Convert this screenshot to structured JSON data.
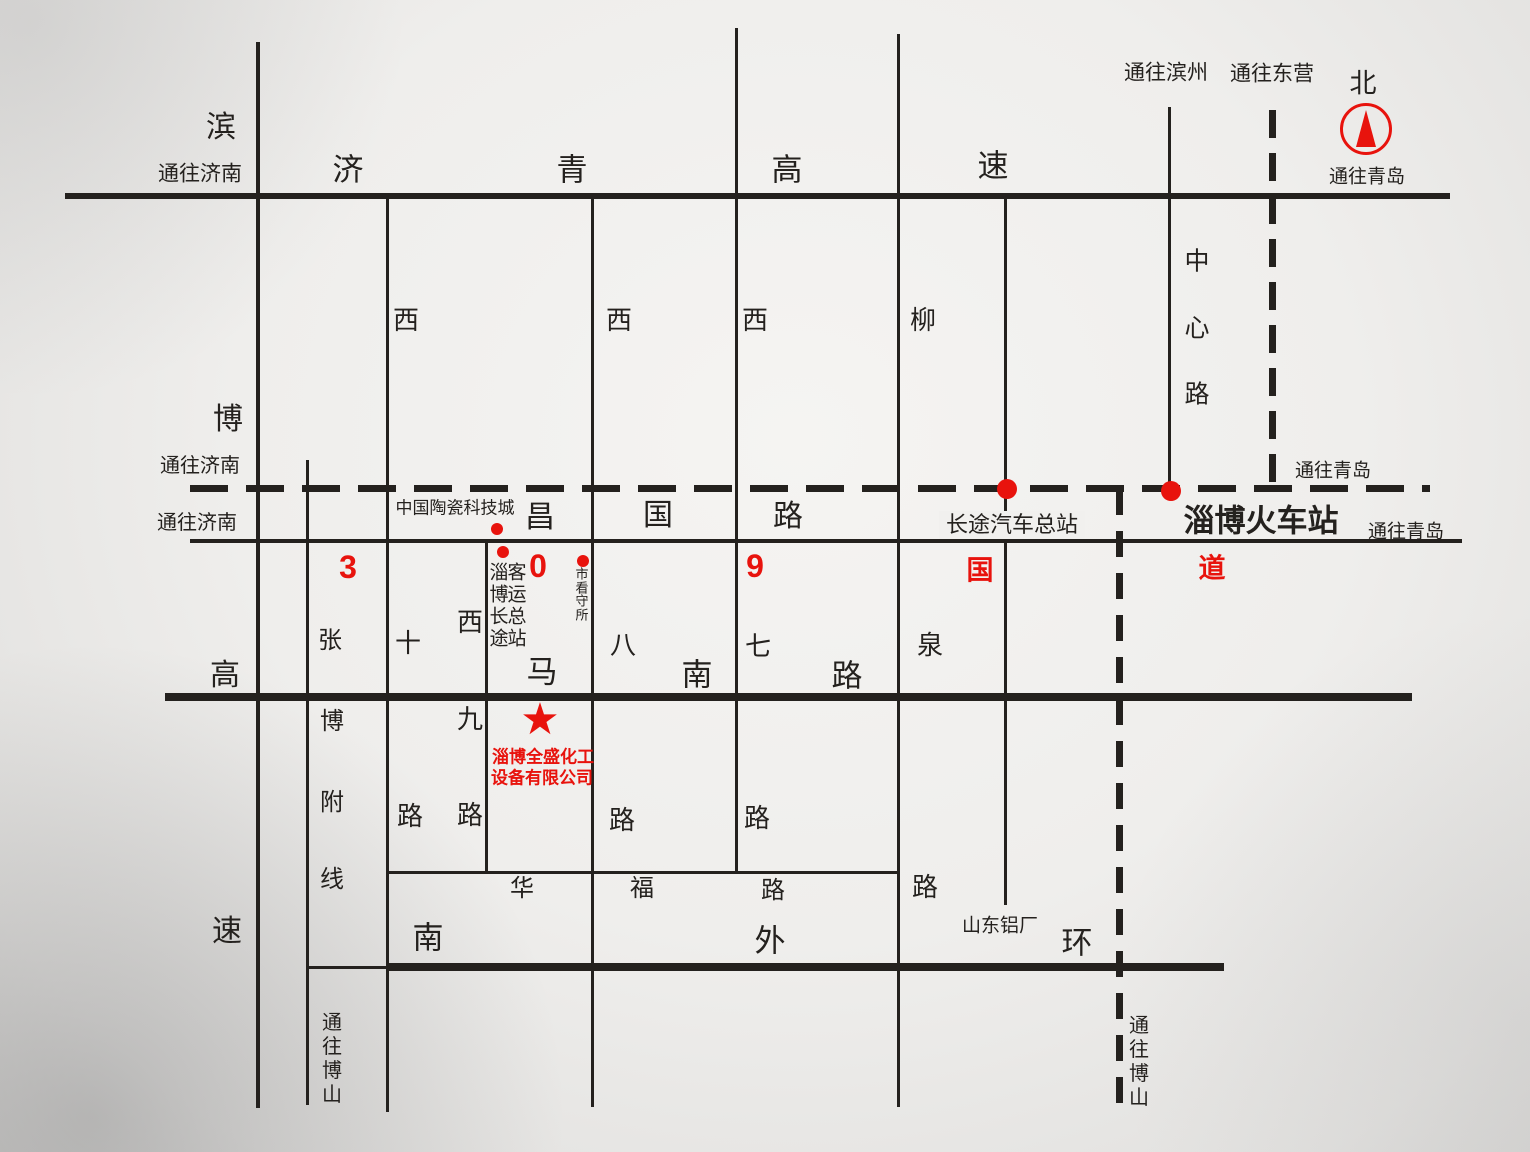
{
  "colors": {
    "ink": "#24211e",
    "red": "#e8130d",
    "paper": "#f1f0ee"
  },
  "company": {
    "name_line1": "淄博全盛化工",
    "name_line2": "设备有限公司"
  },
  "compass": {
    "north_label": "北"
  },
  "roads": [
    {
      "name": "jiqing-expressway",
      "cn": "济青高速",
      "o": "h",
      "x": 65,
      "y": 193,
      "len": 1385,
      "t": 6
    },
    {
      "name": "g309-national-road",
      "cn": "309国道",
      "o": "h",
      "x": 190,
      "y": 485,
      "len": 1240,
      "t": 7,
      "dash": [
        38,
        18
      ]
    },
    {
      "name": "changguo-road",
      "cn": "昌国路",
      "o": "h",
      "x": 190,
      "y": 539,
      "len": 1272,
      "t": 4
    },
    {
      "name": "manan-road",
      "cn": "马南路",
      "o": "h",
      "x": 165,
      "y": 693,
      "len": 1247,
      "t": 8
    },
    {
      "name": "huafu-road",
      "cn": "华福路",
      "o": "h",
      "x": 386,
      "y": 871,
      "len": 513,
      "t": 3
    },
    {
      "name": "nanwaihuan-west-segment",
      "cn": "南外环",
      "o": "h",
      "x": 308,
      "y": 966,
      "len": 80,
      "t": 3
    },
    {
      "name": "nanwaihuan-road",
      "cn": "南外环",
      "o": "h",
      "x": 386,
      "y": 963,
      "len": 838,
      "t": 8
    },
    {
      "name": "binbo-expressway",
      "cn": "滨博高速",
      "o": "v",
      "x": 256,
      "y": 42,
      "len": 1066,
      "t": 4
    },
    {
      "name": "zhangbo-branch-line",
      "cn": "张博附线",
      "o": "v",
      "x": 306,
      "y": 460,
      "len": 645,
      "t": 3
    },
    {
      "name": "xishi-road",
      "cn": "西十路",
      "o": "v",
      "x": 386,
      "y": 196,
      "len": 916,
      "t": 3
    },
    {
      "name": "xijiu-road",
      "cn": "西九路",
      "o": "v",
      "x": 485,
      "y": 539,
      "len": 334,
      "t": 3
    },
    {
      "name": "xiba-road",
      "cn": "西八路",
      "o": "v",
      "x": 591,
      "y": 196,
      "len": 911,
      "t": 3
    },
    {
      "name": "xiqi-road",
      "cn": "西七路",
      "o": "v",
      "x": 735,
      "y": 28,
      "len": 845,
      "t": 3
    },
    {
      "name": "liuquan-road",
      "cn": "柳泉路",
      "o": "v",
      "x": 897,
      "y": 34,
      "len": 1073,
      "t": 3
    },
    {
      "name": "bus-terminal-road",
      "o": "v",
      "x": 1004,
      "y": 196,
      "len": 709,
      "t": 3
    },
    {
      "name": "huanshan-dashed-road",
      "o": "v",
      "x": 1116,
      "y": 489,
      "len": 621,
      "t": 7,
      "dash": [
        26,
        16
      ]
    },
    {
      "name": "zhongxin-road",
      "cn": "中心路",
      "o": "v",
      "x": 1168,
      "y": 107,
      "len": 384,
      "t": 3
    },
    {
      "name": "dongying-dashed-road",
      "o": "v",
      "x": 1269,
      "y": 110,
      "len": 382,
      "t": 7,
      "dash": [
        28,
        15
      ]
    }
  ],
  "labels": [
    {
      "name": "jiqing-char-1",
      "text": "济",
      "x": 348,
      "y": 170,
      "fs": 31
    },
    {
      "name": "jiqing-char-2",
      "text": "青",
      "x": 572,
      "y": 170,
      "fs": 31
    },
    {
      "name": "jiqing-char-3",
      "text": "高",
      "x": 787,
      "y": 170,
      "fs": 31
    },
    {
      "name": "jiqing-char-4",
      "text": "速",
      "x": 993,
      "y": 166,
      "fs": 31
    },
    {
      "name": "binbo-char-1",
      "text": "滨",
      "x": 221,
      "y": 128,
      "fs": 30
    },
    {
      "name": "binbo-char-2",
      "text": "博",
      "x": 228,
      "y": 420,
      "fs": 30
    },
    {
      "name": "binbo-char-3",
      "text": "高",
      "x": 225,
      "y": 676,
      "fs": 30
    },
    {
      "name": "binbo-char-4",
      "text": "速",
      "x": 227,
      "y": 932,
      "fs": 30
    },
    {
      "name": "changguo-char-1",
      "text": "昌",
      "x": 540,
      "y": 518,
      "fs": 30
    },
    {
      "name": "changguo-char-2",
      "text": "国",
      "x": 658,
      "y": 516,
      "fs": 30
    },
    {
      "name": "changguo-char-3",
      "text": "路",
      "x": 788,
      "y": 517,
      "fs": 30
    },
    {
      "name": "manan-char-1",
      "text": "马",
      "x": 542,
      "y": 672,
      "fs": 31
    },
    {
      "name": "manan-char-2",
      "text": "南",
      "x": 697,
      "y": 675,
      "fs": 31
    },
    {
      "name": "manan-char-3",
      "text": "路",
      "x": 847,
      "y": 676,
      "fs": 31
    },
    {
      "name": "nanwaihuan-char-1",
      "text": "南",
      "x": 428,
      "y": 938,
      "fs": 31
    },
    {
      "name": "nanwaihuan-char-2",
      "text": "外",
      "x": 770,
      "y": 941,
      "fs": 31
    },
    {
      "name": "nanwaihuan-char-3",
      "text": "环",
      "x": 1077,
      "y": 943,
      "fs": 31
    },
    {
      "name": "huafu-char-1",
      "text": "华",
      "x": 522,
      "y": 889,
      "fs": 24
    },
    {
      "name": "huafu-char-2",
      "text": "福",
      "x": 642,
      "y": 889,
      "fs": 24
    },
    {
      "name": "huafu-char-3",
      "text": "路",
      "x": 773,
      "y": 891,
      "fs": 24
    },
    {
      "name": "zhangbo-char-1",
      "text": "张",
      "x": 330,
      "y": 641,
      "fs": 24
    },
    {
      "name": "zhangbo-char-2",
      "text": "博",
      "x": 332,
      "y": 722,
      "fs": 24
    },
    {
      "name": "zhangbo-char-3",
      "text": "附",
      "x": 332,
      "y": 803,
      "fs": 24
    },
    {
      "name": "zhangbo-char-4",
      "text": "线",
      "x": 332,
      "y": 880,
      "fs": 24
    },
    {
      "name": "xishi-char-1",
      "text": "西",
      "x": 406,
      "y": 320,
      "fs": 26
    },
    {
      "name": "xishi-char-2",
      "text": "十",
      "x": 408,
      "y": 643,
      "fs": 26
    },
    {
      "name": "xishi-char-3",
      "text": "路",
      "x": 410,
      "y": 816,
      "fs": 26
    },
    {
      "name": "xijiu-char-1",
      "text": "西",
      "x": 470,
      "y": 622,
      "fs": 26
    },
    {
      "name": "xijiu-char-2",
      "text": "九",
      "x": 470,
      "y": 719,
      "fs": 26
    },
    {
      "name": "xijiu-char-3",
      "text": "路",
      "x": 470,
      "y": 815,
      "fs": 26
    },
    {
      "name": "xiba-char-1",
      "text": "西",
      "x": 619,
      "y": 320,
      "fs": 26
    },
    {
      "name": "xiba-char-2",
      "text": "八",
      "x": 623,
      "y": 645,
      "fs": 26
    },
    {
      "name": "xiba-char-3",
      "text": "路",
      "x": 622,
      "y": 820,
      "fs": 26
    },
    {
      "name": "xiqi-char-1",
      "text": "西",
      "x": 755,
      "y": 320,
      "fs": 26
    },
    {
      "name": "xiqi-char-2",
      "text": "七",
      "x": 758,
      "y": 646,
      "fs": 26
    },
    {
      "name": "xiqi-char-3",
      "text": "路",
      "x": 757,
      "y": 818,
      "fs": 26
    },
    {
      "name": "liuquan-char-1",
      "text": "柳",
      "x": 923,
      "y": 320,
      "fs": 26
    },
    {
      "name": "liuquan-char-2",
      "text": "泉",
      "x": 930,
      "y": 645,
      "fs": 26
    },
    {
      "name": "liuquan-char-3",
      "text": "路",
      "x": 925,
      "y": 887,
      "fs": 26
    },
    {
      "name": "zhongxin-char-1",
      "text": "中",
      "x": 1197,
      "y": 262,
      "fs": 25
    },
    {
      "name": "zhongxin-char-2",
      "text": "心",
      "x": 1197,
      "y": 329,
      "fs": 25
    },
    {
      "name": "zhongxin-char-3",
      "text": "路",
      "x": 1197,
      "y": 395,
      "fs": 25
    },
    {
      "name": "dir-jinan-jiqing",
      "text": "通往济南",
      "x": 200,
      "y": 174,
      "fs": 21
    },
    {
      "name": "dir-jinan-g309",
      "text": "通往济南",
      "x": 200,
      "y": 466,
      "fs": 20
    },
    {
      "name": "dir-jinan-changguo",
      "text": "通往济南",
      "x": 197,
      "y": 523,
      "fs": 20
    },
    {
      "name": "dir-binzhou",
      "text": "通往滨州",
      "x": 1166,
      "y": 73,
      "fs": 21
    },
    {
      "name": "dir-dongying",
      "text": "通往东营",
      "x": 1272,
      "y": 74,
      "fs": 21
    },
    {
      "name": "north-label",
      "text": "北",
      "x": 1363,
      "y": 84,
      "fs": 27
    },
    {
      "name": "dir-qingdao-compass",
      "text": "通往青岛",
      "x": 1367,
      "y": 177,
      "fs": 19
    },
    {
      "name": "dir-qingdao-g309",
      "text": "通往青岛",
      "x": 1333,
      "y": 471,
      "fs": 19
    },
    {
      "name": "dir-qingdao-changguo",
      "text": "通往青岛",
      "x": 1406,
      "y": 532,
      "fs": 19
    },
    {
      "name": "dir-boshan-west",
      "text": "通往博山",
      "x": 332,
      "y": 1059,
      "fs": 20,
      "v": true
    },
    {
      "name": "dir-boshan-east",
      "text": "通往博山",
      "x": 1139,
      "y": 1062,
      "fs": 20,
      "v": true
    },
    {
      "name": "ceramics-city",
      "text": "中国陶瓷科技城",
      "x": 455,
      "y": 508,
      "fs": 17
    },
    {
      "name": "bus-terminal",
      "text": "长途汽车总站",
      "x": 1012,
      "y": 525,
      "fs": 22,
      "bg": true
    },
    {
      "name": "railway-station",
      "text": "淄博火车站",
      "x": 1261,
      "y": 521,
      "fs": 31,
      "bold": true
    },
    {
      "name": "shandong-aluminum",
      "text": "山东铝厂",
      "x": 1000,
      "y": 926,
      "fs": 19
    },
    {
      "name": "detention-center",
      "text": "市看守所",
      "x": 582,
      "y": 595,
      "fs": 13,
      "v": true,
      "lh": 1.05
    },
    {
      "name": "coach-station-col-1",
      "text": "淄博长途",
      "x": 499,
      "y": 606,
      "fs": 19,
      "v": true,
      "lh": 1.15
    },
    {
      "name": "coach-station-col-2",
      "text": "客运总站",
      "x": 517,
      "y": 606,
      "fs": 19,
      "v": true,
      "lh": 1.15
    },
    {
      "name": "g309-digit-3",
      "text": "3",
      "x": 348,
      "y": 567,
      "fs": 32,
      "red": true,
      "bold": true
    },
    {
      "name": "g309-digit-0",
      "text": "0",
      "x": 538,
      "y": 566,
      "fs": 32,
      "red": true,
      "bold": true
    },
    {
      "name": "g309-digit-9",
      "text": "9",
      "x": 755,
      "y": 566,
      "fs": 32,
      "red": true,
      "bold": true
    },
    {
      "name": "g309-char-guo",
      "text": "国",
      "x": 980,
      "y": 571,
      "fs": 27,
      "red": true,
      "bold": true
    },
    {
      "name": "g309-char-dao",
      "text": "道",
      "x": 1212,
      "y": 569,
      "fs": 27,
      "red": true,
      "bold": true
    },
    {
      "name": "company-name-line-1",
      "text": "淄博全盛化工",
      "x": 543,
      "y": 757,
      "fs": 17,
      "red": true,
      "bold": true
    },
    {
      "name": "company-name-line-2",
      "text": "设备有限公司",
      "x": 542,
      "y": 778,
      "fs": 17,
      "red": true,
      "bold": true
    }
  ],
  "markers": {
    "dots": [
      {
        "name": "dot-ceramics-city",
        "x": 497,
        "y": 529,
        "r": 6
      },
      {
        "name": "dot-coach-station",
        "x": 503,
        "y": 552,
        "r": 6
      },
      {
        "name": "dot-detention-center",
        "x": 583,
        "y": 561,
        "r": 6
      },
      {
        "name": "dot-bus-terminal",
        "x": 1007,
        "y": 489,
        "r": 10
      },
      {
        "name": "dot-railway-station",
        "x": 1171,
        "y": 491,
        "r": 10
      }
    ],
    "star": {
      "name": "company-location-star",
      "glyph": "★",
      "x": 540,
      "y": 720,
      "fs": 44
    }
  }
}
